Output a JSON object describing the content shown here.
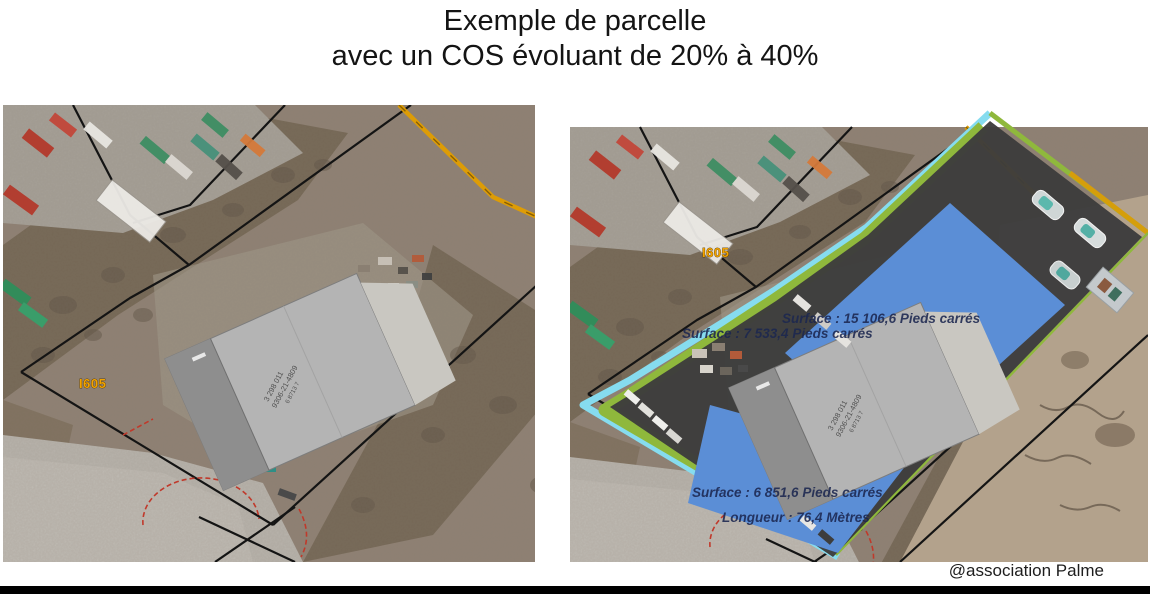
{
  "title": {
    "line1": "Exemple de parcelle",
    "line2": "avec un COS évoluant de 20% à 40%"
  },
  "footer": {
    "attribution": "@association Palme"
  },
  "maps": {
    "left": {
      "road_label": "I605"
    },
    "right": {
      "road_label": "I605",
      "surface_top": "Surface : 15 106,6 Pieds carrés",
      "surface_mid": "Surface : 7 533,4 Pieds carrés",
      "surface_bottom": "Surface : 6 851,6 Pieds carrés",
      "length": "Longueur : 76,4 Mètres"
    },
    "building_id": {
      "line1": "3 298 011",
      "line2": "9306-21-4809",
      "line3": "6 8713 7"
    },
    "legend_colors": {
      "existing_building_gray": "#b4b4b4",
      "expansion_blue": "#5b8ed6",
      "buffer_green": "#8fb83c",
      "edge_cyan": "#86dcef",
      "parcel_mask_dark": "#3c3c3c",
      "road_orange": "#dd9c06",
      "cadastral_line_black": "#141414",
      "label_navy": "#1c2750",
      "red_dashed": "#c0392b"
    }
  }
}
